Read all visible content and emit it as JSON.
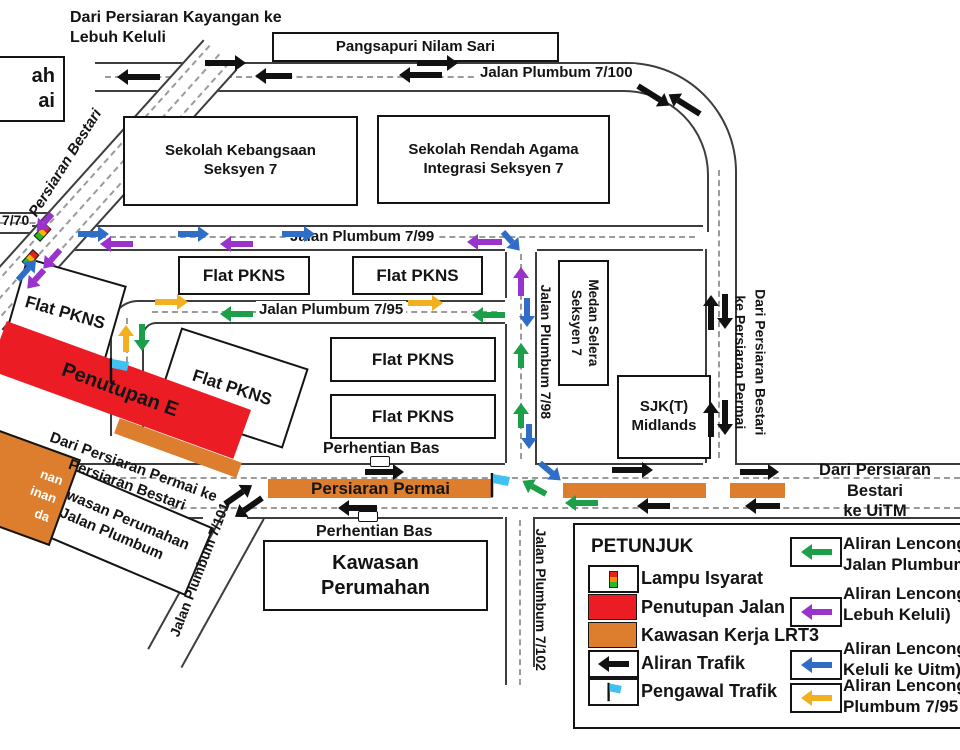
{
  "colors": {
    "green": "#1BA049",
    "purple": "#9933CC",
    "blue": "#2F6DC6",
    "yellow": "#F2B01E",
    "orange": "#DD7E2E",
    "red": "#EC1C24",
    "cyan": "#3FC1F2"
  },
  "map": {
    "from_kayangan": "Dari Persiaran Kayangan ke\nLebuh Keluli",
    "pangsapuri": "Pangsapuri Nilam Sari",
    "jalan_plumbum_7_100": "Jalan Plumbum 7/100",
    "left_box_fragment": "ah\nai",
    "jalan_7_70_fragment": "7/70",
    "persiaran_bestari": "Persiaran Bestari",
    "sekolah_kebangsaan": "Sekolah Kebangsaan\nSeksyen 7",
    "sekolah_rendah": "Sekolah Rendah Agama\nIntegrasi Seksyen 7",
    "jalan_plumbum_7_99": "Jalan Plumbum 7/99",
    "flat_pkns": "Flat PKNS",
    "jalan_plumbum_7_95": "Jalan Plumbum 7/95",
    "jalan_plumbum_7_98": "Jalan Plumbum 7/98",
    "medan_selera": "Medan Selera\nSeksyen 7",
    "sjkt_midlands": "SJK(T)\nMidlands",
    "dari_bestari_ke_permai": "Dari Persiaran Bestari\nke Persiaran Permai",
    "penutupan_e": "Penutupan E",
    "dari_permai_ke_bestari": "Dari Persiaran Permai ke\nPersiaran Bestari",
    "kawasan_perumahan_jalan_plumbum": "Kawasan Perumahan\nJalan Plumbum",
    "orange_box_fragment": "nan\ninan\nda",
    "perhentian_bas_atas": "Perhentian Bas",
    "perhentian_bas_bawah": "Perhentian Bas",
    "persiaran_permai": "Persiaran Permai",
    "kawasan_perumahan": "Kawasan\nPerumahan",
    "jalan_plumbum_7_101": "Jalan Plumbum 7/101",
    "jalan_plumbum_7_102": "Jalan Plumbum 7/102",
    "dari_bestari_ke_uitm": "Dari Persiaran Bestari\nke UiTM"
  },
  "legend": {
    "title": "PETUNJUK",
    "left": [
      {
        "icon": "traffic-light",
        "label": "Lampu Isyarat"
      },
      {
        "icon": "road-closure",
        "label": "Penutupan Jalan"
      },
      {
        "icon": "lrt3-work-area",
        "label": "Kawasan Kerja LRT3"
      },
      {
        "icon": "traffic-flow-arrow",
        "label": "Aliran Trafik"
      },
      {
        "icon": "traffic-marshal-flag",
        "label": "Pengawal Trafik"
      }
    ],
    "right": [
      {
        "arrow_color": "#1BA049",
        "label": "Aliran Lenconga\nJalan Plumbum"
      },
      {
        "arrow_color": "#9933CC",
        "label": "Aliran Lenconga\nLebuh Keluli)"
      },
      {
        "arrow_color": "#2F6DC6",
        "label": "Aliran Lenconga\nKeluli ke Uitm)"
      },
      {
        "arrow_color": "#F2B01E",
        "label": "Aliran Lenconga\nPlumbum 7/95"
      }
    ]
  }
}
